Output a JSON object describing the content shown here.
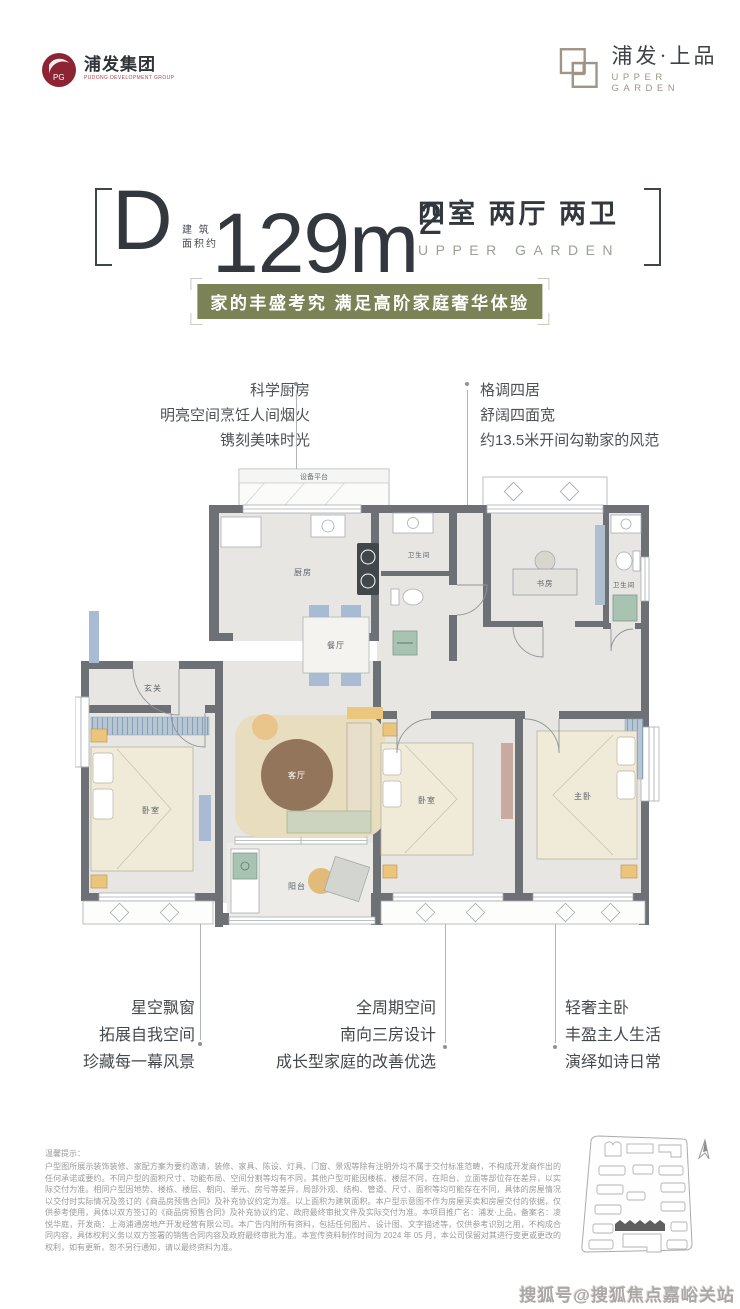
{
  "header": {
    "group_logo": {
      "cn": "浦发集团",
      "en": "PUDONG DEVELOPMENT GROUP"
    },
    "brand_logo": {
      "cn": "浦发·上品",
      "en": "UPPER GARDEN"
    }
  },
  "title": {
    "unit": "D",
    "area_prefix_line1": "建 筑",
    "area_prefix_line2": "面积约",
    "area": "129m",
    "area_sup": "2",
    "rooms": "四室 两厅 两卫",
    "rooms_en": "UPPER GARDEN"
  },
  "banner": {
    "text": "家的丰盛考究 满足高阶家庭奢华体验"
  },
  "callouts": {
    "top_left": {
      "lines": [
        "科学厨房",
        "明亮空间烹饪人间烟火",
        "镌刻美味时光"
      ]
    },
    "top_right": {
      "lines": [
        "格调四居",
        "舒阔四面宽",
        "约13.5米开间勾勒家的风范"
      ]
    },
    "bottom_left": {
      "lines": [
        "星空飘窗",
        "拓展自我空间",
        "珍藏每一幕风景"
      ]
    },
    "bottom_center": {
      "lines": [
        "全周期空间",
        "南向三房设计",
        "成长型家庭的改善优选"
      ]
    },
    "bottom_right": {
      "lines": [
        "轻奢主卧",
        "丰盈主人生活",
        "演绎如诗日常"
      ]
    }
  },
  "floorplan": {
    "rooms": {
      "equipment": "设备平台",
      "kitchen": "厨房",
      "bath1": "卫生间",
      "study": "书房",
      "bath2": "卫生间",
      "dining": "餐厅",
      "foyer": "玄关",
      "living": "客厅",
      "bedroom1": "卧室",
      "bedroom2": "卧室",
      "master": "主卧",
      "balcony": "阳台"
    }
  },
  "disclaimer": {
    "title": "温馨提示：",
    "body": "户型图所展示装饰装修、家配方案为要约邀请，装修、家具、陈设、灯具、门窗、景观等除有注明外均不属于交付标准范畴，不构成开发商作出的任何承诺或要约。不同户型的面积尺寸、功能布局、空间分割等均有不同，其他户型可能因楼栋、楼层不同，在阳台、立面等部位存在差异，以实际交付为准。相同户型因地势、楼栋、楼层、朝向、单元、房号等差异，局部外观、结构、管道、尺寸、面积等均可能存在不同，具体的房屋情况以交付时实际情况及签订的《商品房预售合同》及补充协议约定为准。以上面积为建筑面积。本户型示意图不作为房屋买卖和房屋交付的依据，仅供参考使用，具体以双方签订的《商品房预售合同》及补充协议约定、政府最终审批文件及实际交付为准。本项目推广名：浦发·上品，备案名：凌悦华庭，开发商：上海浦通房地产开发经营有限公司。本广告内附所有资料，包括任何图片、设计图、文字描述等，仅供参考识别之用，不构成合同内容，具体权利义务以双方签署的销售合同内容及政府最终审批为准。本宣传资料制作时间为 2024 年 05 月，本公司保留对其进行变更或更改的权利，如有更新，恕不另行通知，请以最终资料为准。"
  },
  "watermark": "搜狐号@搜狐焦点嘉峪关站",
  "colors": {
    "banner_green": "#7a8256",
    "logo_maroon": "#8c2433",
    "brand_tan": "#a09584",
    "wall_gray": "#6d7074"
  }
}
